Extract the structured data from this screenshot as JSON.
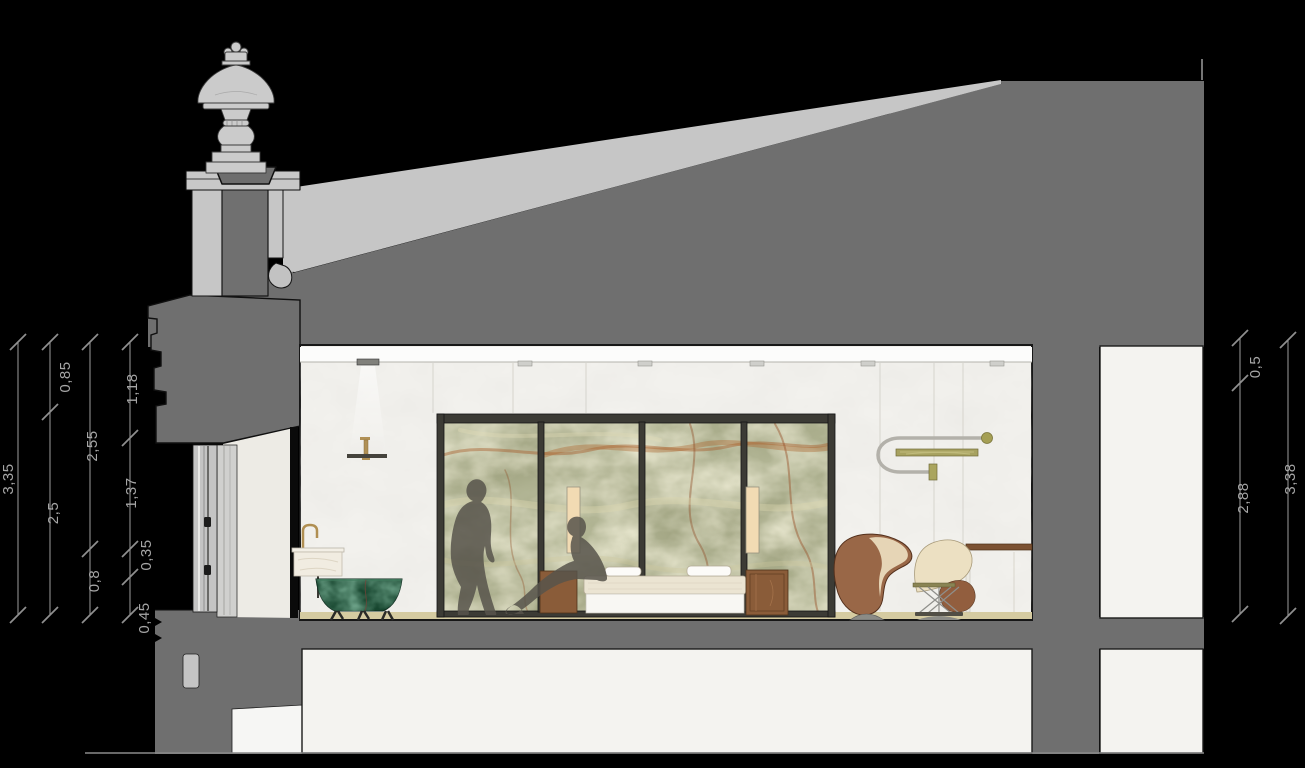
{
  "dims": {
    "left": [
      "3,35",
      "0,85",
      "2,5",
      "2,55",
      "0,8",
      "1,18",
      "1,37",
      "0,35",
      "0,45"
    ],
    "right": [
      "0,5",
      "2,88",
      "3,38"
    ]
  },
  "palette": {
    "background": "#000000",
    "roof_cut_gray": "#6f6f6f",
    "masonry_light_gray": "#c6c6c6",
    "wall_white": "#f2f1ed",
    "ceiling_white": "#fcfcfb",
    "onyx_green": "#a2a583",
    "onyx_rust_vein": "#a85f2e",
    "tub_green_marble": "#17462f",
    "floor_tan": "#d5cba1",
    "wood_brown": "#8a5c39",
    "leather_brown": "#996747",
    "upholstery_cream": "#eadbbd",
    "brass": "#b09055",
    "fixture_olive": "#a7a260",
    "figure_silhouette": "#57544b",
    "dimension_text": "#a6a6a6"
  }
}
